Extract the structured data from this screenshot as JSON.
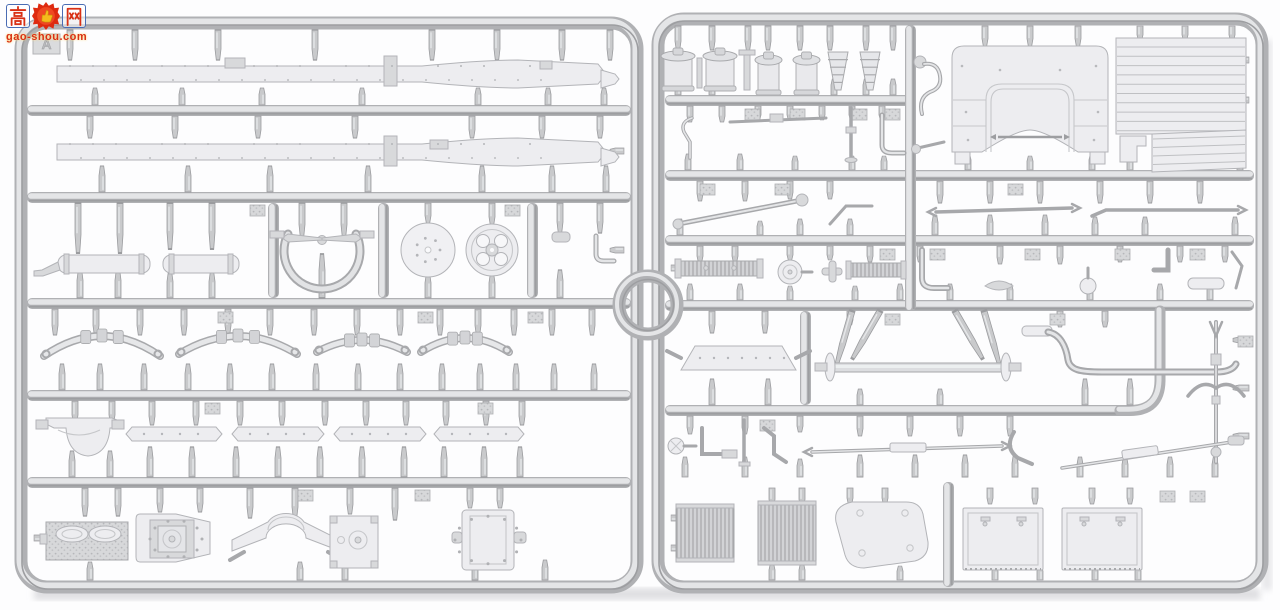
{
  "scene": {
    "type": "photograph",
    "subject": "light-grey injection-moulded styrene sprue with truck model parts",
    "sprue_tag": "A",
    "background": "white studio backdrop"
  },
  "watermark": {
    "char_left": "高",
    "char_right": "网",
    "badge_icon": "thumbs-up-badge",
    "site": "gao-shou.com"
  },
  "palette": {
    "background": "#fdfdfe",
    "runner_dark": "#b0b1b4",
    "runner_light": "#e4e5e7",
    "runner_mid": "#c8c9cb",
    "runner_shade": "#9d9ea1",
    "part_fill": "#ededf0",
    "part_line": "#b3b4b8",
    "part_texture": "#d8d9db",
    "watermark_red": "#d93014",
    "watermark_blue": "#4a6cb3",
    "watermark_yellow": "#f5bb1c"
  },
  "sprue": {
    "left_frame_parts": [
      "chassis side rail (x2)",
      "exhaust muffler (x2)",
      "fan shroud half with fan",
      "solid disc wheel",
      "spare wheel hub with 4 holes",
      "leaf spring (x4)",
      "differential housing",
      "frame crossmember (x4)",
      "engine block with rocker covers",
      "gearbox cover plate",
      "axle saddle bracket",
      "inspection plate",
      "transfer case"
    ],
    "right_frame_parts": [
      "air-cleaner drum (x2)",
      "filler pot (x2)",
      "coil spring cone (x2)",
      "horn and small levers",
      "cab rear panel with window arch",
      "slatted bed panel with sub-panel",
      "steering drag link",
      "tie rod (x2)",
      "ribbed manifold (x2)",
      "round gauge pulley",
      "support bracket plate",
      "front axle with kingpin braces",
      "curved exhaust downpipe",
      "steering column lever",
      "turnbuckle rod (x2)",
      "radiator core (x2)",
      "tank end plate",
      "door panel (x2)"
    ]
  }
}
